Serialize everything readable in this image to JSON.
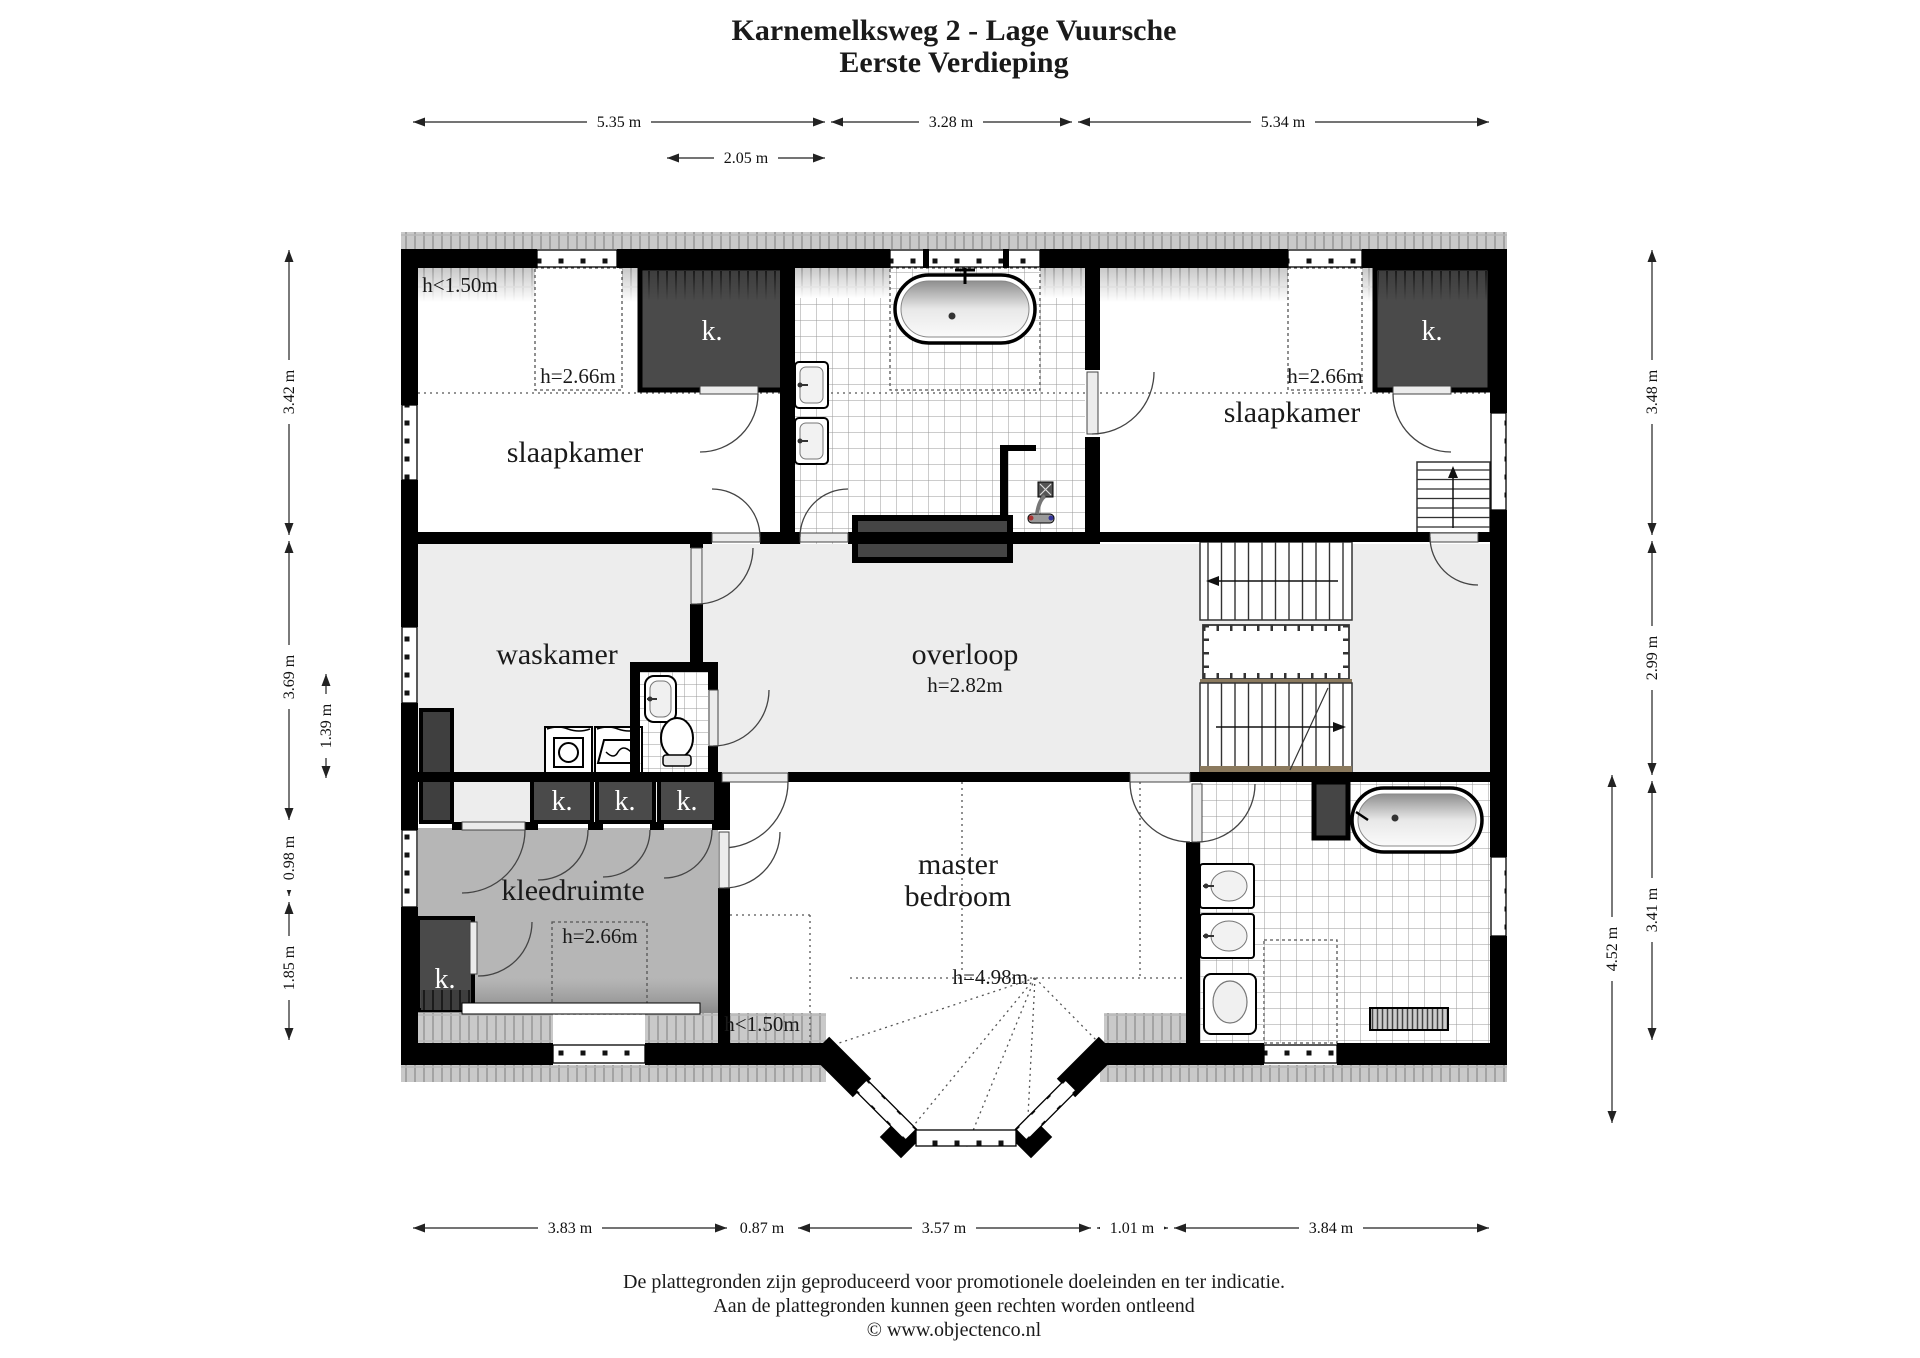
{
  "title": {
    "line1": "Karnemelksweg 2 - Lage Vuursche",
    "line2": "Eerste Verdieping"
  },
  "dimensions": {
    "top": [
      "5.35 m",
      "3.28 m",
      "5.34 m"
    ],
    "top_inner": "2.05 m",
    "bottom": [
      "3.83 m",
      "0.87 m",
      "3.57 m",
      "1.01 m",
      "3.84 m"
    ],
    "left": [
      "3.42 m",
      "3.69 m",
      "0.98 m",
      "1.85 m"
    ],
    "left_inner": "1.39 m",
    "right": [
      "3.48 m",
      "2.99 m",
      "3.41 m"
    ],
    "right_inner": "4.52 m"
  },
  "rooms": {
    "slaapkamer_left": "slaapkamer",
    "slaapkamer_right": "slaapkamer",
    "waskamer": "waskamer",
    "overloop": "overloop",
    "overloop_height": "h=2.82m",
    "kleedruimte": "kleedruimte",
    "master_line1": "master",
    "master_line2": "bedroom",
    "master_height": "h=4.98m"
  },
  "height_labels": {
    "low_top_left": "h<1.50m",
    "low_bottom": "h<1.50m",
    "dormer_left": "h=2.66m",
    "dormer_right": "h=2.66m",
    "dormer_kleedruimte": "h=2.66m"
  },
  "closet_labels": {
    "top_left": "k.",
    "top_right": "k.",
    "row_1": "k.",
    "row_2": "k.",
    "row_3": "k.",
    "bottom_left": "k."
  },
  "footer": {
    "line1": "De plattegronden zijn geproduceerd voor promotionele doeleinden en ter indicatie.",
    "line2": "Aan de plattegronden kunnen geen rechten worden ontleend",
    "line3": "© www.objectenco.nl"
  },
  "colors": {
    "wall": "#000000",
    "closet": "#4a4a4a",
    "floor_light": "#ededed",
    "floor_kleedruimte": "#b6b6b6",
    "roof_band": "#c9c9c9"
  }
}
